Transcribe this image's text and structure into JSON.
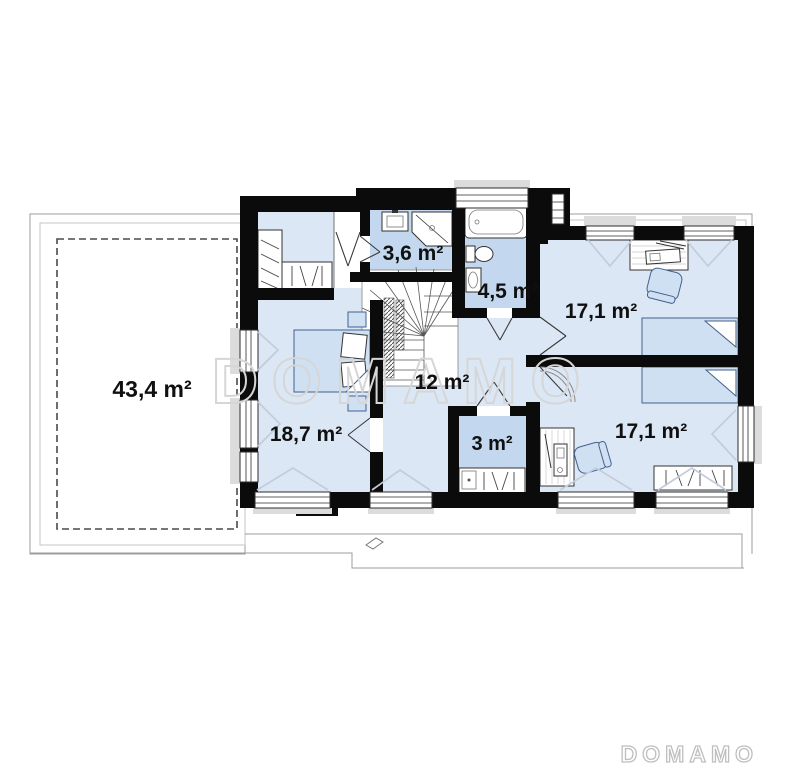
{
  "plan": {
    "title": "second floor plan",
    "watermark": {
      "center": "DOMAMO",
      "brand": "DOMAMO"
    },
    "rooms": [
      {
        "id": "terrace",
        "area": "43,4 m²"
      },
      {
        "id": "bathroom-small",
        "area": "3,6 m²"
      },
      {
        "id": "bathroom",
        "area": "4,5 m²"
      },
      {
        "id": "bedroom-top-right",
        "area": "17,1 m²"
      },
      {
        "id": "hall",
        "area": "12 m²"
      },
      {
        "id": "bedroom-left",
        "area": "18,7 m²"
      },
      {
        "id": "wardrobe-closet",
        "area": "3 m²"
      },
      {
        "id": "bedroom-bottom-right",
        "area": "17,1 m²"
      }
    ],
    "colors": {
      "wall": "#0b0b0b",
      "room_floor": "#dce7f5",
      "wet_room_floor": "#c3d7ee",
      "bed_fill": "#cfe0f3",
      "watermark_gray": "#d6d6d6"
    }
  }
}
